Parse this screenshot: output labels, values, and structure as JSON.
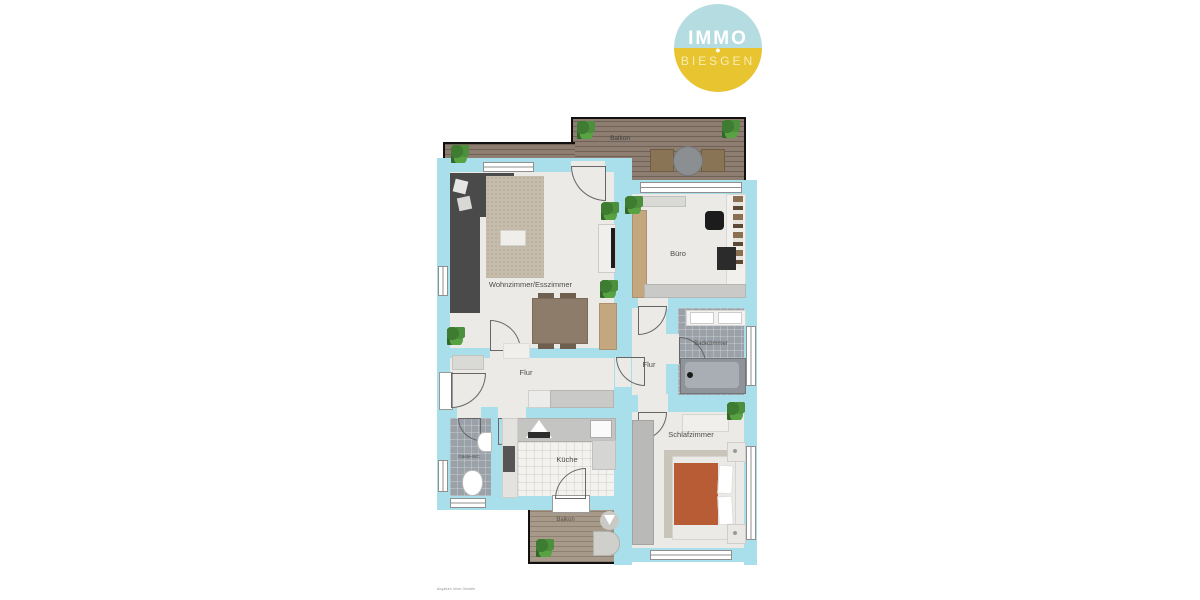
{
  "logo": {
    "line1": "IMMO",
    "dot": "●",
    "line2": "BIESGEN",
    "top_color": "#b5dce1",
    "bottom_color": "#e9c431"
  },
  "plan": {
    "rooms": [
      {
        "id": "balkon-oben",
        "label": "Balkon"
      },
      {
        "id": "wohnzimmer",
        "label": "Wohnzimmer/Esszimmer"
      },
      {
        "id": "buero",
        "label": "Büro"
      },
      {
        "id": "badezimmer",
        "label": "Badezimmer"
      },
      {
        "id": "flur",
        "label": "Flur"
      },
      {
        "id": "flur-klein",
        "label": "Flur"
      },
      {
        "id": "gaeste-wc",
        "label": "Gäste-WC"
      },
      {
        "id": "kueche",
        "label": "Küche"
      },
      {
        "id": "schlafzimmer",
        "label": "Schlafzimmer"
      },
      {
        "id": "balkon-unten",
        "label": "Balkon"
      }
    ],
    "colors": {
      "wall": "#a9dfeb",
      "floor": "#ebeae6",
      "deck_dark": "#8d7e71",
      "deck_light": "#a89a8b",
      "bath_tile": "#9ba1a8",
      "sofa": "#4a4a4a",
      "dining_table": "#8d7c69",
      "bed_cover": "#b85c35",
      "outer_border": "#111111"
    }
  },
  "footer": {
    "disclaimer": "Angaben ohne Gewähr"
  }
}
